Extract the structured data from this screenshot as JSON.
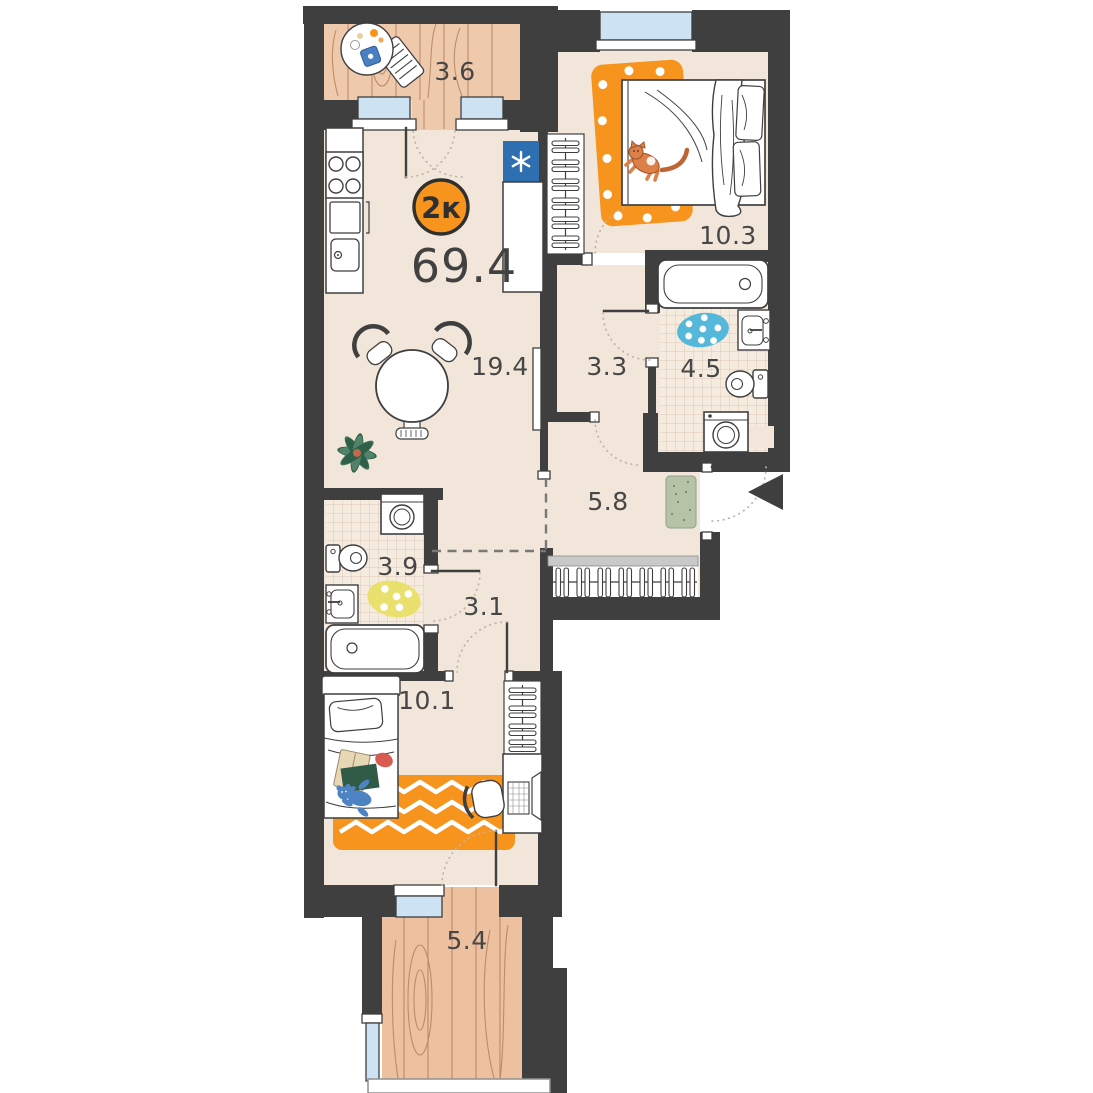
{
  "plan": {
    "badge": {
      "type_label": "2к",
      "area_value": "69.4"
    },
    "rooms": [
      {
        "name": "balcony-top",
        "area": "3.6"
      },
      {
        "name": "bedroom-main",
        "area": "10.3"
      },
      {
        "name": "kitchen-living",
        "area": "19.4"
      },
      {
        "name": "hallway",
        "area": "3.3"
      },
      {
        "name": "bathroom-main",
        "area": "4.5"
      },
      {
        "name": "entry-hall",
        "area": "5.8"
      },
      {
        "name": "bathroom-guest",
        "area": "3.9"
      },
      {
        "name": "corridor",
        "area": "3.1"
      },
      {
        "name": "bedroom-kids",
        "area": "10.1"
      },
      {
        "name": "balcony-bottom",
        "area": "5.4"
      }
    ],
    "colors": {
      "wall": "#3f3f3f",
      "floor": "#f1e6d9",
      "tile": "#f6ebdf",
      "wood": "#eec5a6",
      "window": "#cde2f3",
      "accent_orange": "#f7941e",
      "fridge_blue": "#2e6fb2",
      "rug_blue": "#55b7d9",
      "rug_yellow": "#e9e06e",
      "mat_green": "#b7c3a6"
    }
  }
}
